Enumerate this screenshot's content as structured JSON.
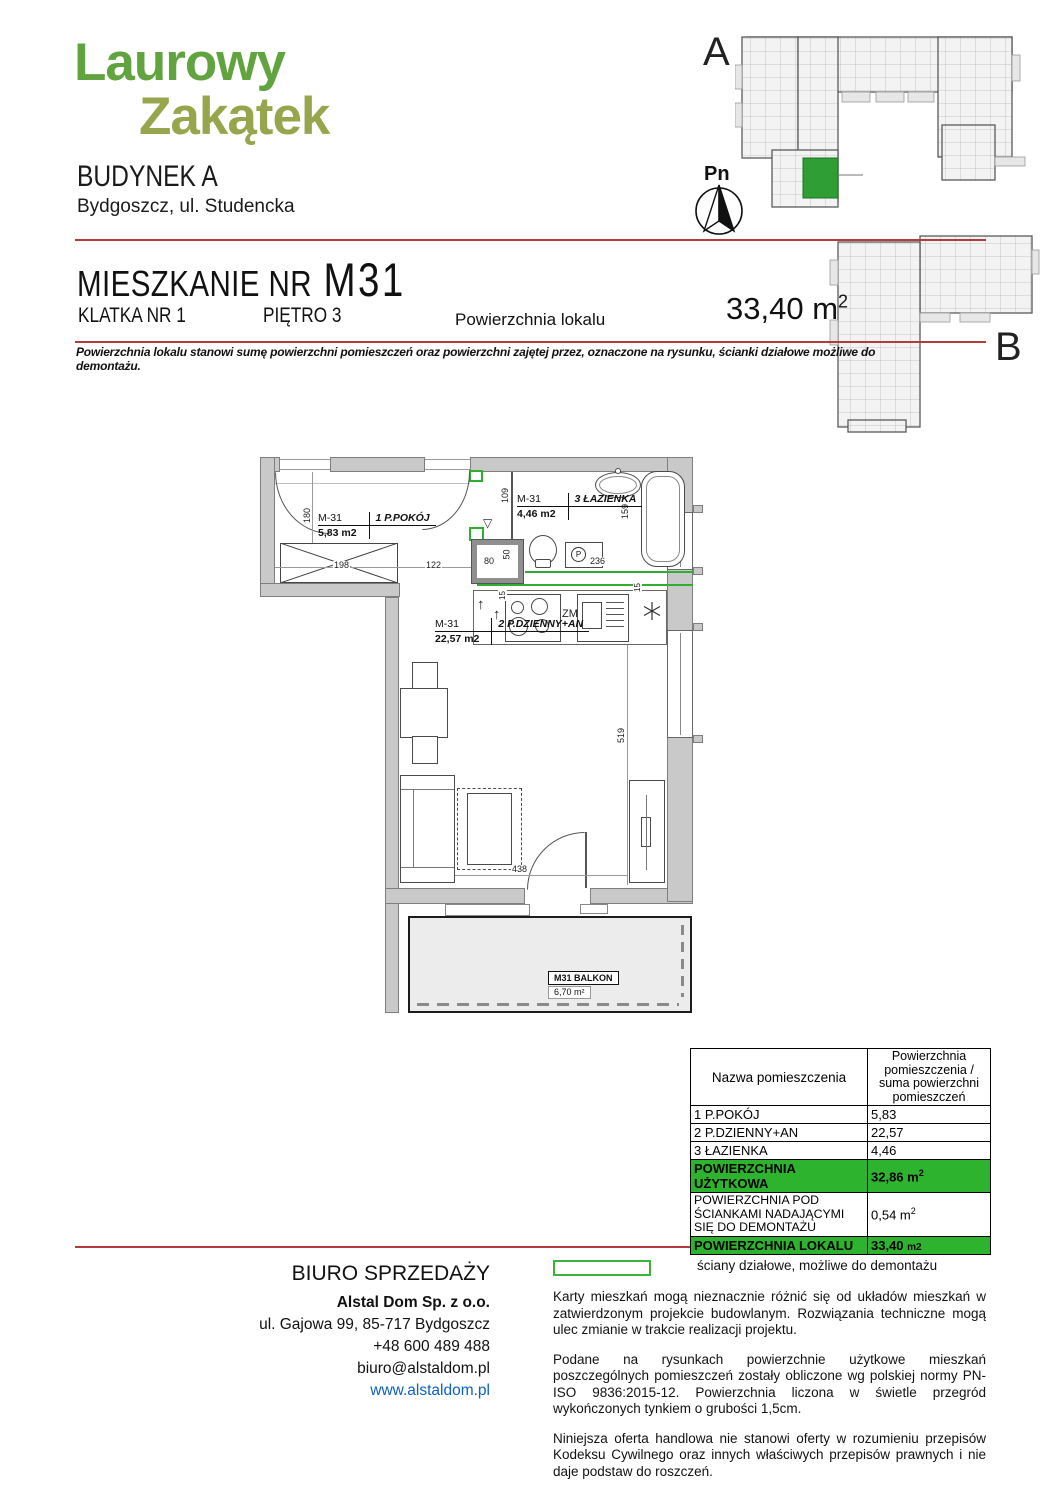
{
  "brand": {
    "line1": "Laurowy",
    "line2": "Zakątek",
    "building": "BUDYNEK A",
    "address": "Bydgoszcz, ul. Studencka"
  },
  "overview": {
    "label_a": "A",
    "label_b": "B",
    "compass": "Pn"
  },
  "title": {
    "prefix": "MIESZKANIE NR",
    "unit": "M31",
    "staircase": "KLATKA NR 1",
    "floor": "PIĘTRO 3",
    "area_label": "Powierzchnia lokalu",
    "area_value": "33,40 m",
    "area_sup": "2",
    "note": "Powierzchnia lokalu stanowi sumę powierzchni pomieszczeń oraz powierzchni zajętej przez, oznaczone na rysunku, ścianki działowe możliwe do demontażu."
  },
  "plan": {
    "rooms": [
      {
        "code": "M-31",
        "area": "5,83 m2",
        "name": "1 P.POKÓJ"
      },
      {
        "code": "M-31",
        "area": "4,46 m2",
        "name": "3 ŁAZIENKA"
      },
      {
        "code": "M-31",
        "area": "22,57 m2",
        "name": "2 P.DZIENNY+AN"
      }
    ],
    "balcony": {
      "name": "M31 BALKON",
      "area": "6,70 m²"
    },
    "fixtures": {
      "dishwasher": "ZM",
      "washer": "P",
      "door_marker": "▽",
      "vent_arrow": "↑"
    },
    "dims": {
      "hall_height": "180",
      "wardrobe": "198",
      "hall_width": "122",
      "shaft_w": "80",
      "shaft_h": "50",
      "bath_corridor": "109",
      "tub": "159",
      "washer_dim": "236",
      "counter_a": "15",
      "counter_b": "15",
      "room_height": "519",
      "room_width": "438"
    }
  },
  "table": {
    "col1": "Nazwa pomieszczenia",
    "col2": "Powierzchnia pomieszczenia / suma powierzchni pomieszczeń",
    "rows": [
      {
        "name": "1 P.POKÓJ",
        "value": "5,83"
      },
      {
        "name": "2 P.DZIENNY+AN",
        "value": "22,57"
      },
      {
        "name": "3 ŁAZIENKA",
        "value": "4,46"
      }
    ],
    "useful_label": "POWIERZCHNIA UŻYTKOWA",
    "useful_value": "32,86 m",
    "useful_sup": "2",
    "demolition_label": "POWIERZCHNIA POD ŚCIANKAMI NADAJĄCYMI SIĘ DO DEMONTAŻU",
    "demolition_value": "0,54 m",
    "demolition_sup": "2",
    "total_label": "POWIERZCHNIA LOKALU",
    "total_value": "33,40 ",
    "total_unit": "m2"
  },
  "footer": {
    "office_title": "BIURO SPRZEDAŻY",
    "company": "Alstal Dom Sp. z o.o.",
    "address": "ul. Gajowa 99, 85-717 Bydgoszcz",
    "phone": "+48 600 489 488",
    "email": "biuro@alstaldom.pl",
    "website": "www.alstaldom.pl",
    "legend": "ściany działowe, możliwe do demontażu",
    "para1": "Karty mieszkań mogą nieznacznie różnić się od układów mieszkań w zatwierdzonym projekcie budowlanym. Rozwiązania techniczne mogą ulec zmianie w trakcie realizacji projektu.",
    "para2": "Podane na rysunkach powierzchnie użytkowe mieszkań poszczególnych pomieszczeń zostały obliczone wg polskiej normy PN-ISO 9836:2015-12. Powierzchnia liczona w świetle przegród wykończonych tynkiem o grubości 1,5cm.",
    "para3": "Niniejsza oferta handlowa nie stanowi oferty w rozumieniu przepisów Kodeksu Cywilnego oraz innych właściwych przepisów prawnych i nie daje podstaw do roszczeń."
  }
}
